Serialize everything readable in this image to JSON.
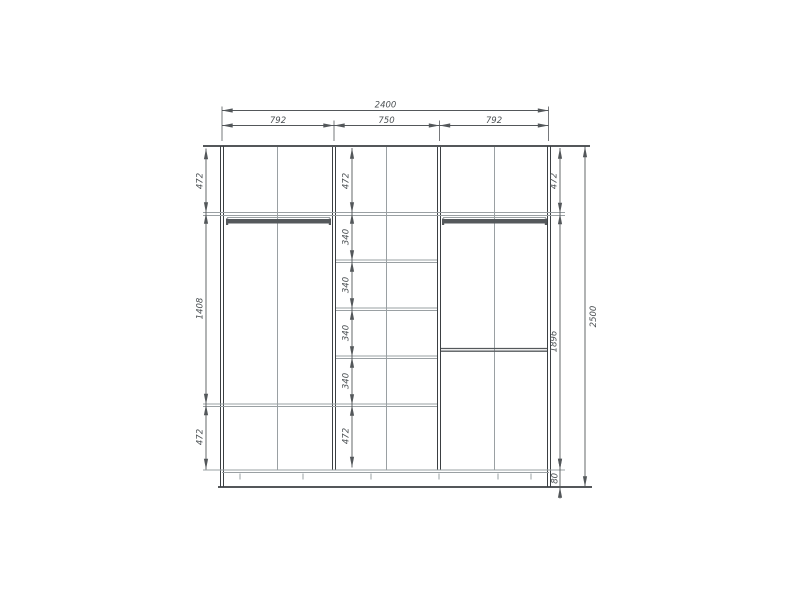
{
  "colors": {
    "background": "#ffffff",
    "line_dark": "#3b3f42",
    "line_medium": "#55595c",
    "line_light": "#9aa0a3",
    "dim_line": "#53575a",
    "text": "#4b5053"
  },
  "dimensions": {
    "overall_width": "2400",
    "section_widths": [
      "792",
      "750",
      "792"
    ],
    "left_heights": [
      "472",
      "1408",
      "472"
    ],
    "center_heights": [
      "472",
      "340",
      "340",
      "340",
      "340",
      "472"
    ],
    "right_heights": [
      "472",
      "1896",
      "80"
    ],
    "overall_height": "2500"
  }
}
